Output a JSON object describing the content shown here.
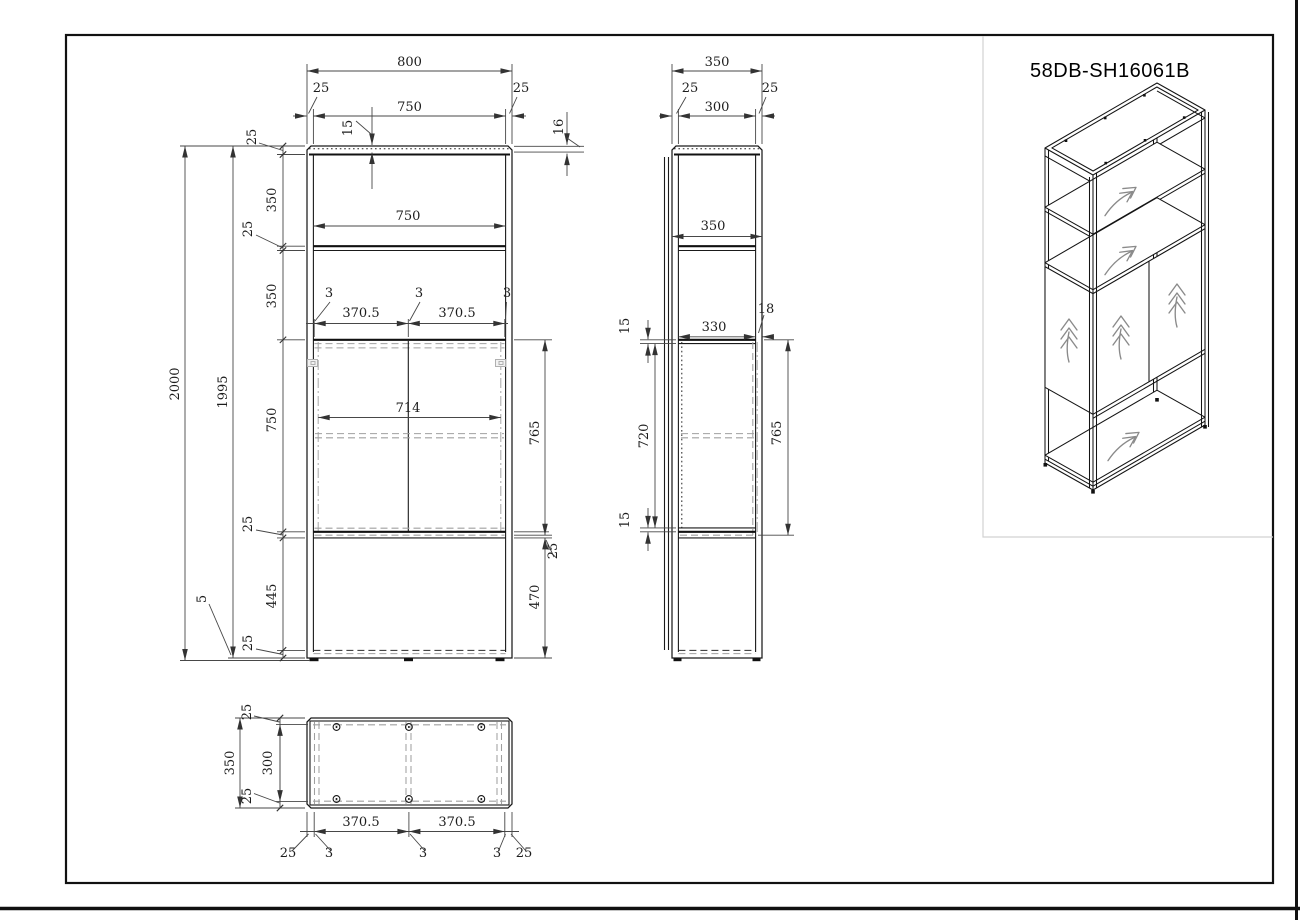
{
  "part_number": "58DB-SH16061B",
  "front_view": {
    "overall_width": "800",
    "inner_width": "750",
    "corner_inset_left": "25",
    "corner_inset_right": "25",
    "top_lip": "15",
    "top_panel_thickness": "16",
    "shelf_inner_width": "750",
    "overall_height": "2000",
    "frame_height": "1995",
    "foot_height": "5",
    "left_chain": [
      "25",
      "350",
      "25",
      "350",
      "750",
      "25",
      "445",
      "25"
    ],
    "door_gap_left": "3",
    "door_gap_center": "3",
    "door_gap_right": "3",
    "door_width_left": "370.5",
    "door_width_right": "370.5",
    "door_opening_width": "714",
    "door_height": "765",
    "shelf_thickness": "25",
    "base_opening_height": "470"
  },
  "side_view": {
    "overall_depth": "350",
    "inner_depth": "300",
    "corner_inset_front": "25",
    "corner_inset_back": "25",
    "shelf_depth": "350",
    "top_lip": "15",
    "bottom_lip": "15",
    "door_inner_depth": "330",
    "door_thickness": "18",
    "door_opening_height": "720",
    "door_height": "765"
  },
  "top_view": {
    "overall_depth": "350",
    "inner_depth": "300",
    "corner_inset_top": "25",
    "corner_inset_bottom": "25",
    "door_width_left": "370.5",
    "door_width_right": "370.5",
    "edge_inset_left": "25",
    "edge_inset_right": "25",
    "gap_left": "3",
    "gap_center": "3",
    "gap_right": "3"
  }
}
